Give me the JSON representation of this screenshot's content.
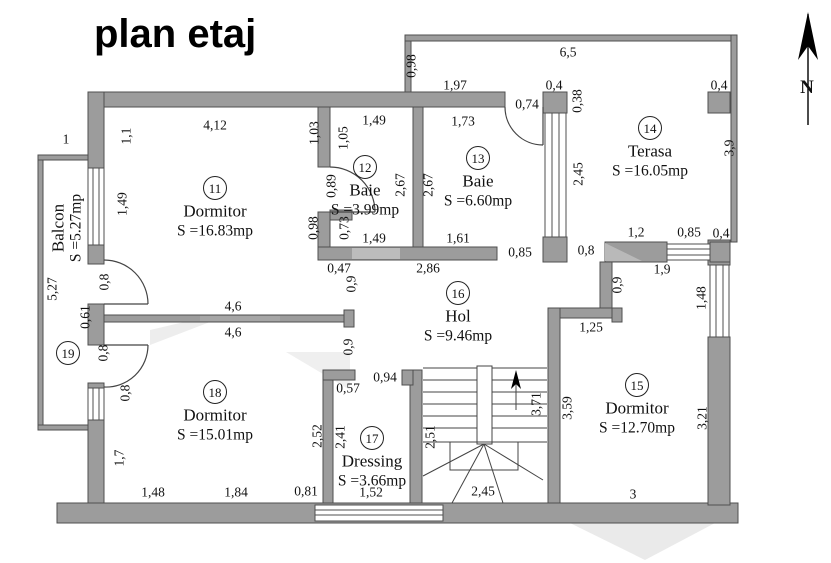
{
  "title": "plan etaj",
  "compass": {
    "label": "N"
  },
  "rooms": [
    {
      "id": "11",
      "name": "Dormitor",
      "area": "S =16.83mp",
      "x": 215,
      "y": 188
    },
    {
      "id": "12",
      "name": "Baie",
      "area": "S =3.99mp",
      "x": 365,
      "y": 167
    },
    {
      "id": "13",
      "name": "Baie",
      "area": "S =6.60mp",
      "x": 478,
      "y": 158
    },
    {
      "id": "14",
      "name": "Terasa",
      "area": "S =16.05mp",
      "x": 650,
      "y": 128
    },
    {
      "id": "15",
      "name": "Dormitor",
      "area": "S =12.70mp",
      "x": 637,
      "y": 385
    },
    {
      "id": "16",
      "name": "Hol",
      "area": "S =9.46mp",
      "x": 458,
      "y": 293
    },
    {
      "id": "17",
      "name": "Dressing",
      "area": "S =3.66mp",
      "x": 372,
      "y": 438
    },
    {
      "id": "18",
      "name": "Dormitor",
      "area": "S =15.01mp",
      "x": 215,
      "y": 392
    }
  ],
  "balcony": {
    "id": "19",
    "name": "Balcon",
    "area": "S =5.27mp"
  },
  "dimensions": [
    {
      "t": "6,5",
      "x": 568,
      "y": 52
    },
    {
      "t": "1,97",
      "x": 455,
      "y": 85
    },
    {
      "t": "0,4",
      "x": 554,
      "y": 85
    },
    {
      "t": "0,74",
      "x": 527,
      "y": 104
    },
    {
      "t": "0,4",
      "x": 719,
      "y": 85
    },
    {
      "t": "4,12",
      "x": 215,
      "y": 125
    },
    {
      "t": "1,49",
      "x": 374,
      "y": 120
    },
    {
      "t": "1,73",
      "x": 463,
      "y": 121
    },
    {
      "t": "1",
      "x": 66,
      "y": 139
    },
    {
      "t": "1,49",
      "x": 374,
      "y": 238
    },
    {
      "t": "1,61",
      "x": 458,
      "y": 238
    },
    {
      "t": "0,47",
      "x": 339,
      "y": 268
    },
    {
      "t": "2,86",
      "x": 428,
      "y": 268
    },
    {
      "t": "0,85",
      "x": 520,
      "y": 252
    },
    {
      "t": "0,8",
      "x": 586,
      "y": 250
    },
    {
      "t": "1,2",
      "x": 636,
      "y": 232
    },
    {
      "t": "0,85",
      "x": 689,
      "y": 232
    },
    {
      "t": "0,4",
      "x": 721,
      "y": 233
    },
    {
      "t": "1,9",
      "x": 662,
      "y": 269
    },
    {
      "t": "1,25",
      "x": 591,
      "y": 327
    },
    {
      "t": "4,6",
      "x": 233,
      "y": 306
    },
    {
      "t": "4,6",
      "x": 233,
      "y": 332
    },
    {
      "t": "0,94",
      "x": 385,
      "y": 377
    },
    {
      "t": "0,57",
      "x": 348,
      "y": 388
    },
    {
      "t": "1,48",
      "x": 153,
      "y": 492
    },
    {
      "t": "1,84",
      "x": 236,
      "y": 492
    },
    {
      "t": "0,81",
      "x": 306,
      "y": 491
    },
    {
      "t": "1,52",
      "x": 371,
      "y": 492
    },
    {
      "t": "2,45",
      "x": 483,
      "y": 491
    },
    {
      "t": "3",
      "x": 633,
      "y": 494
    },
    {
      "t": "0,98",
      "x": 411,
      "y": 66,
      "r": 1
    },
    {
      "t": "0,38",
      "x": 577,
      "y": 101,
      "r": 1
    },
    {
      "t": "2,45",
      "x": 578,
      "y": 174,
      "r": 1
    },
    {
      "t": "3,9",
      "x": 729,
      "y": 148,
      "r": 1
    },
    {
      "t": "1,1",
      "x": 126,
      "y": 136,
      "r": 1
    },
    {
      "t": "1,03",
      "x": 314,
      "y": 133,
      "r": 1
    },
    {
      "t": "1,05",
      "x": 343,
      "y": 138,
      "r": 1
    },
    {
      "t": "1,49",
      "x": 122,
      "y": 204,
      "r": 1
    },
    {
      "t": "0,89",
      "x": 331,
      "y": 186,
      "r": 1
    },
    {
      "t": "2,67",
      "x": 400,
      "y": 185,
      "r": 1
    },
    {
      "t": "2,67",
      "x": 428,
      "y": 185,
      "r": 1
    },
    {
      "t": "0,98",
      "x": 313,
      "y": 228,
      "r": 1
    },
    {
      "t": "0,73",
      "x": 344,
      "y": 228,
      "r": 1
    },
    {
      "t": "0,9",
      "x": 351,
      "y": 284,
      "r": 1
    },
    {
      "t": "0,9",
      "x": 348,
      "y": 347,
      "r": 1
    },
    {
      "t": "0,9",
      "x": 617,
      "y": 285,
      "r": 1
    },
    {
      "t": "1,48",
      "x": 701,
      "y": 298,
      "r": 1
    },
    {
      "t": "0,8",
      "x": 104,
      "y": 282,
      "r": 1
    },
    {
      "t": "0,61",
      "x": 85,
      "y": 317,
      "r": 1
    },
    {
      "t": "0,8",
      "x": 103,
      "y": 353,
      "r": 1
    },
    {
      "t": "0,8",
      "x": 125,
      "y": 393,
      "r": 1
    },
    {
      "t": "5,27",
      "x": 52,
      "y": 289,
      "r": 1
    },
    {
      "t": "1,7",
      "x": 119,
      "y": 458,
      "r": 1
    },
    {
      "t": "2,52",
      "x": 317,
      "y": 436,
      "r": 1
    },
    {
      "t": "2,41",
      "x": 340,
      "y": 437,
      "r": 1
    },
    {
      "t": "2,51",
      "x": 430,
      "y": 437,
      "r": 1
    },
    {
      "t": "3,71",
      "x": 536,
      "y": 404,
      "r": 1
    },
    {
      "t": "3,59",
      "x": 567,
      "y": 408,
      "r": 1
    },
    {
      "t": "3,21",
      "x": 702,
      "y": 418,
      "r": 1
    }
  ]
}
